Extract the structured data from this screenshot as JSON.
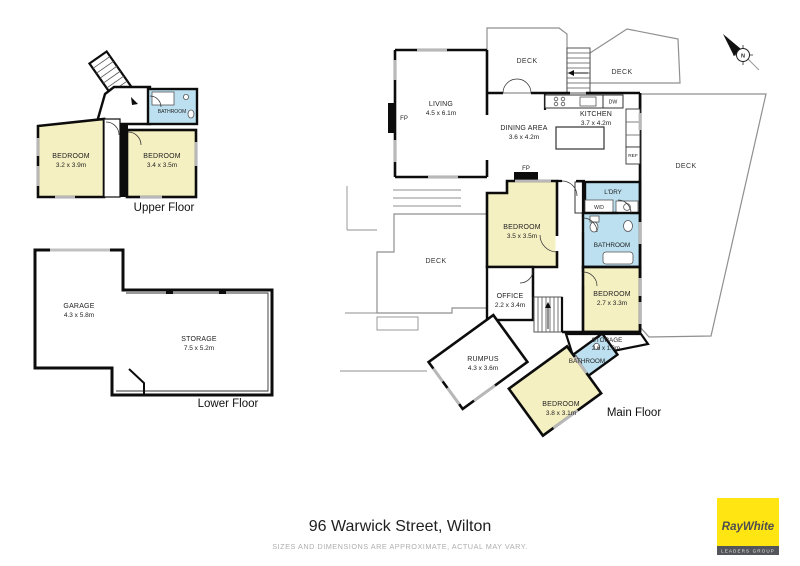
{
  "page": {
    "title": "96 Warwick Street, Wilton",
    "disclaimer": "SIZES AND DIMENSIONS ARE APPROXIMATE, ACTUAL MAY VARY."
  },
  "brand": {
    "name": "RayWhite",
    "tagline": "LEADERS GROUP",
    "yellow": "#FFE512",
    "bar_color": "#54555A"
  },
  "compass": {
    "north": "N"
  },
  "colors": {
    "bedroom_fill": "#F5F0C2",
    "wet_area_fill": "#BCE0F0",
    "wall": "#0C0C0C",
    "deck_line": "#8F8F8F"
  },
  "floors": {
    "upper": {
      "label": "Upper Floor",
      "rooms": {
        "bedroom_left": {
          "name": "BEDROOM",
          "dims": "3.2 x 3.9m"
        },
        "bedroom_right": {
          "name": "BEDROOM",
          "dims": "3.4 x 3.5m"
        },
        "bathroom": {
          "name": "BATHROOM"
        }
      }
    },
    "lower": {
      "label": "Lower Floor",
      "rooms": {
        "garage": {
          "name": "GARAGE",
          "dims": "4.3 x 5.8m"
        },
        "storage": {
          "name": "STORAGE",
          "dims": "7.5 x 5.2m"
        }
      }
    },
    "main": {
      "label": "Main Floor",
      "rooms": {
        "living": {
          "name": "LIVING",
          "dims": "4.5 x 6.1m"
        },
        "dining": {
          "name": "DINING AREA",
          "dims": "3.6 x 4.2m"
        },
        "kitchen": {
          "name": "KITCHEN",
          "dims": "3.7 x 4.2m"
        },
        "bedroom_a": {
          "name": "BEDROOM",
          "dims": "3.5 x 3.5m"
        },
        "bedroom_b": {
          "name": "BEDROOM",
          "dims": "2.7 x 3.3m"
        },
        "bedroom_c": {
          "name": "BEDROOM",
          "dims": "3.8 x 3.1m"
        },
        "office": {
          "name": "OFFICE",
          "dims": "2.2 x 3.4m"
        },
        "rumpus": {
          "name": "RUMPUS",
          "dims": "4.3 x 3.6m"
        },
        "storage": {
          "name": "STORAGE",
          "dims": "2.6 x 1.6m"
        },
        "bathroom_a": {
          "name": "BATHROOM"
        },
        "bathroom_b": {
          "name": "BATHROOM"
        },
        "laundry": {
          "name": "L'DRY"
        },
        "deck_top": {
          "name": "DECK"
        },
        "deck_top_right": {
          "name": "DECK"
        },
        "deck_right": {
          "name": "DECK"
        },
        "deck_left": {
          "name": "DECK"
        },
        "wd": {
          "name": "W/D"
        },
        "dw": {
          "name": "DW"
        },
        "ref": {
          "name": "REF"
        },
        "fp_living": {
          "name": "FP"
        },
        "fp_dining": {
          "name": "FP"
        }
      }
    }
  }
}
